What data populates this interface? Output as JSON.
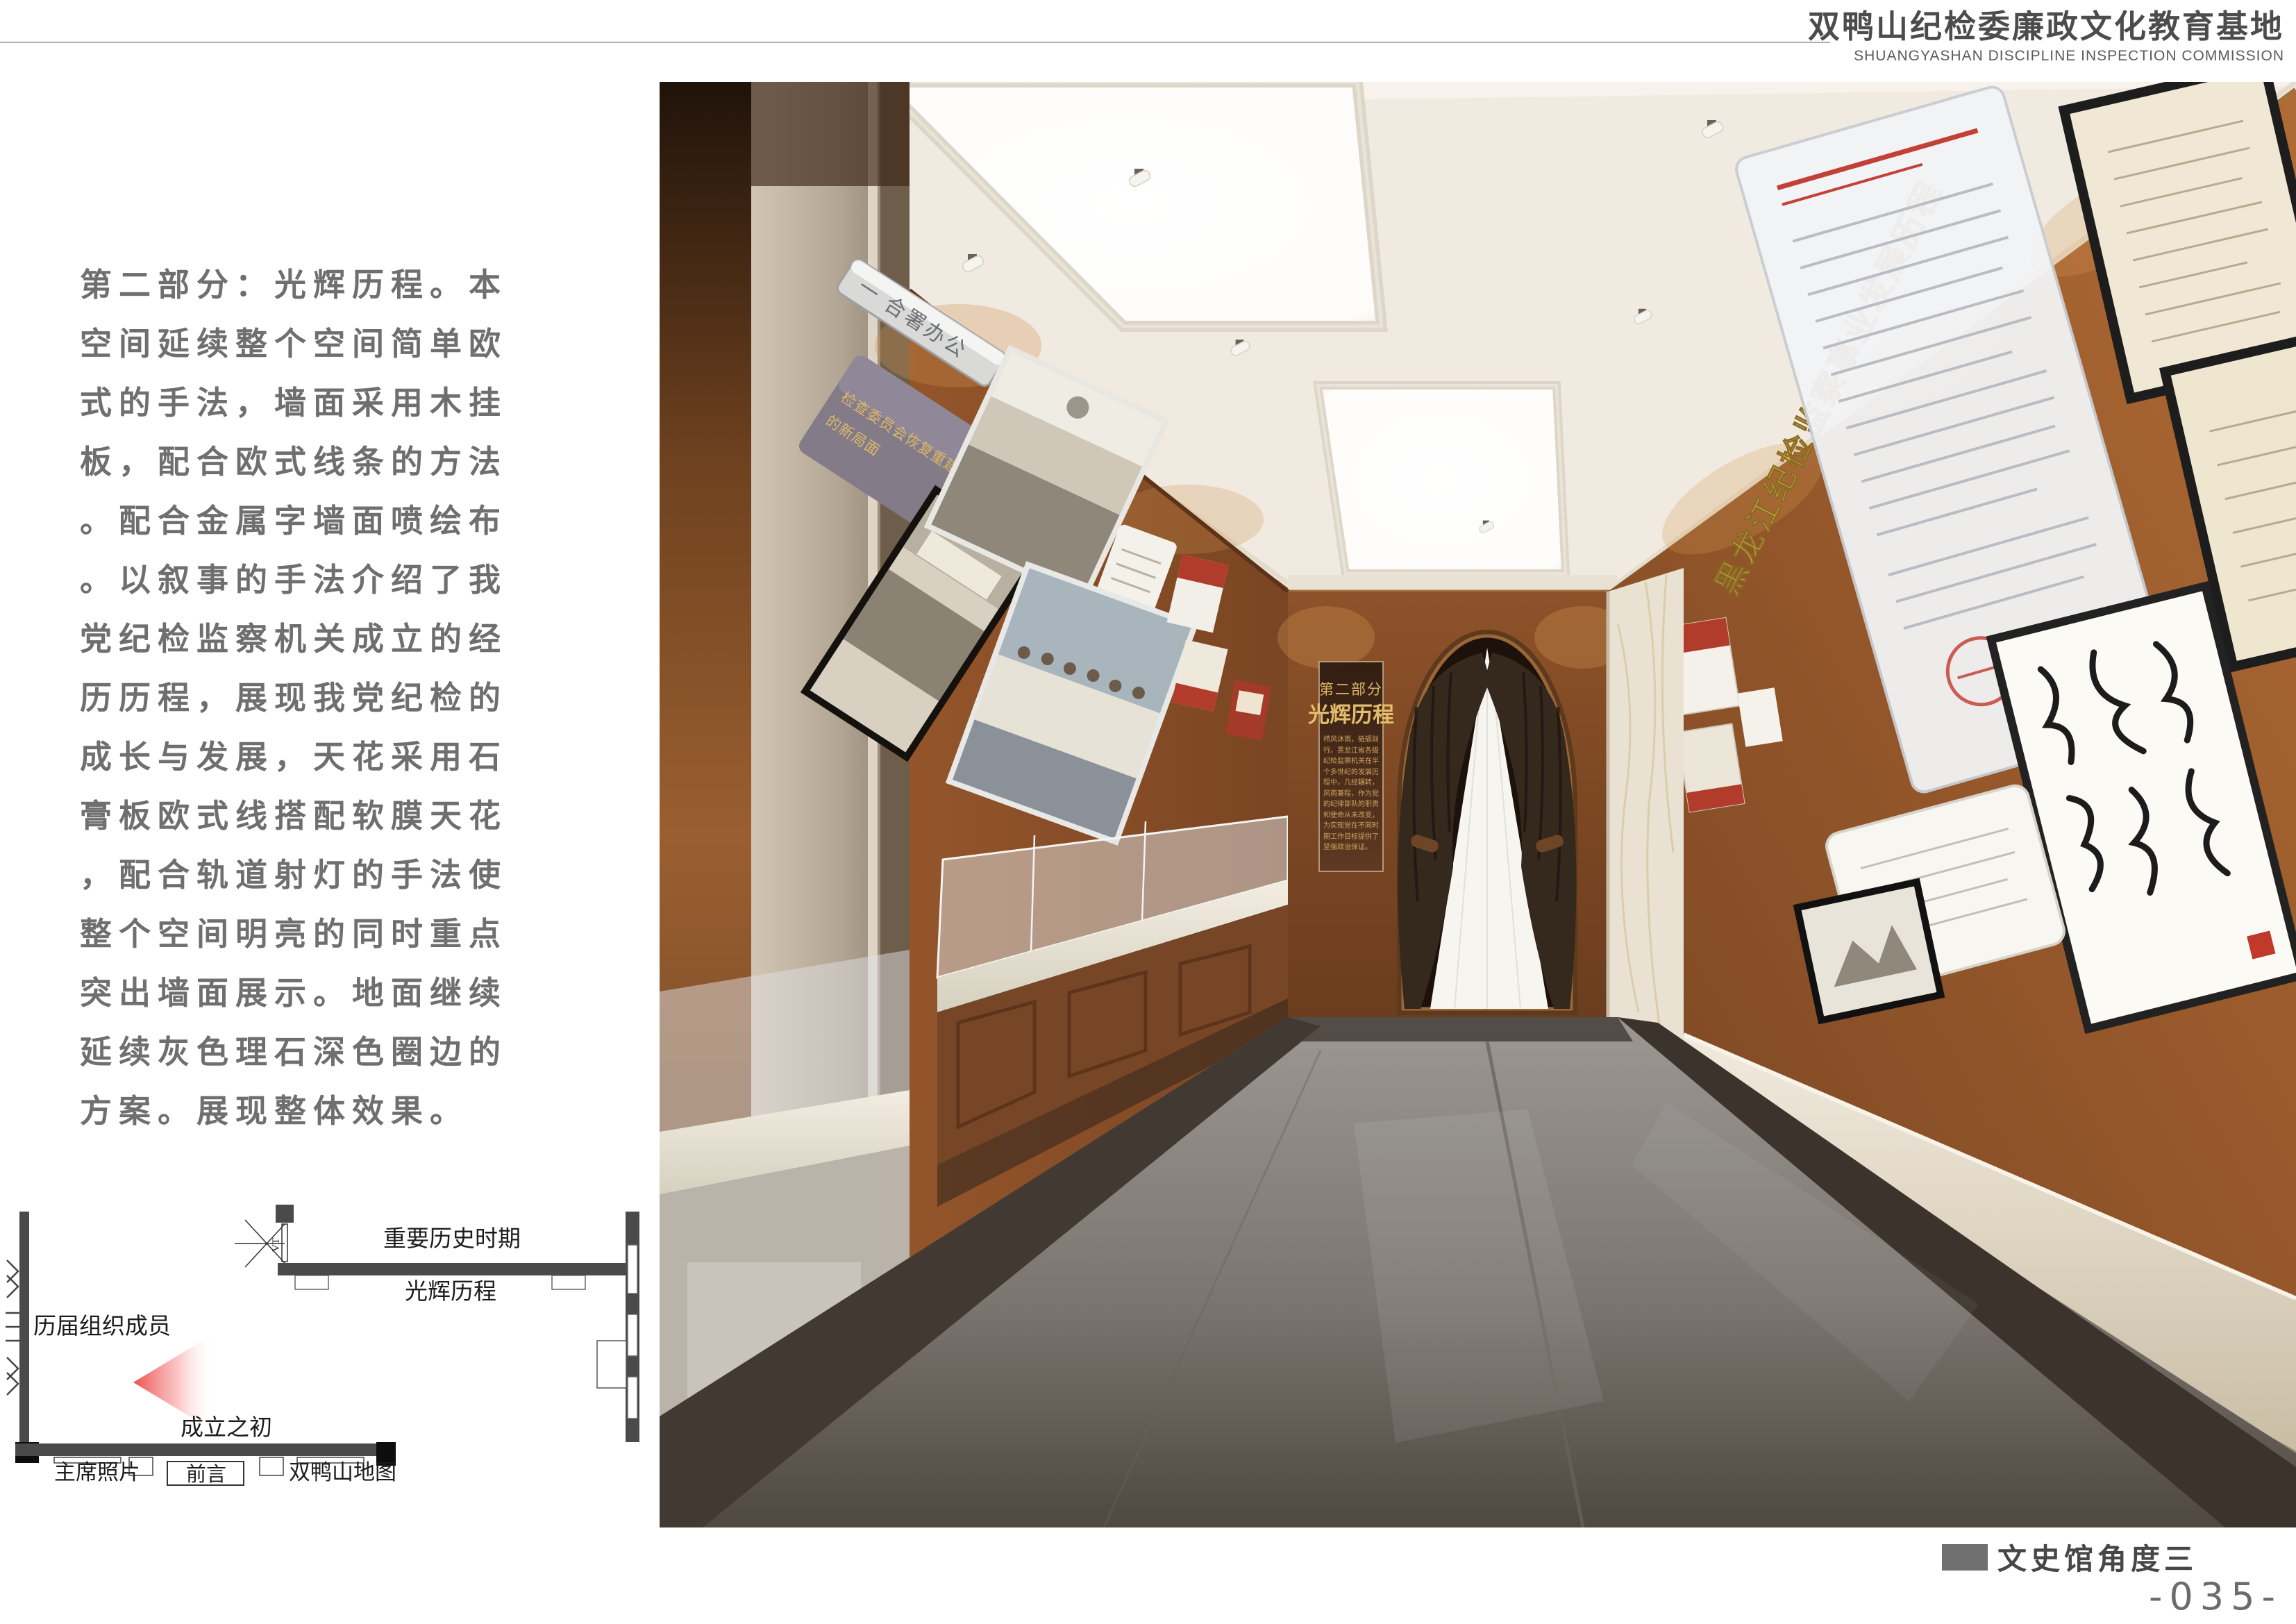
{
  "header": {
    "title": "双鸭山纪检委廉政文化教育基地",
    "subtitle": "SHUANGYASHAN DISCIPLINE INSPECTION COMMISSION"
  },
  "description": {
    "lines": [
      "第二部分：光辉历程。本",
      "空间延续整个空间简单欧",
      "式的手法，墙面采用木挂",
      "板，配合欧式线条的方法",
      "。配合金属字墙面喷绘布",
      "。以叙事的手法介绍了我",
      "党纪检监察机关成立的经",
      "历历程，展现我党纪检的",
      "成长与发展，天花采用石",
      "膏板欧式线搭配软膜天花",
      "，配合轨道射灯的手法使",
      "整个空间明亮的同时重点",
      "突出墙面展示。地面继续",
      "延续灰色理石深色圈边的",
      "方案。展现整体效果。"
    ]
  },
  "floor_plan": {
    "labels": {
      "important_period": "重要历史时期",
      "glorious_course": "光辉历程",
      "members": "历届组织成员",
      "founding": "成立之初",
      "chairman_photos": "主席照片",
      "preface": "前言",
      "map": "双鸭山地图",
      "door_mark": "VT"
    }
  },
  "render": {
    "gold_wall_title": "黑龙江纪检监察事业发展历程",
    "plaque": "一 合署办公",
    "panel_line1": "检查委员会恢复重建，开创了",
    "panel_line2": "的新局面",
    "banner": {
      "part": "第二部分",
      "title": "光辉历程",
      "body": "栉风沐雨，砥砺前行。黑龙江省各级纪检监察机关在半个多世纪的发展历程中，几经辗转，风雨兼程，作为党的纪律部队的职责和使命从未改变，为实现党在不同时期工作目标提供了坚强政治保证。"
    }
  },
  "footer": {
    "caption": "文史馆角度三",
    "page_number": "-035-"
  },
  "colors": {
    "wood": "#8a5129",
    "gold": "#d4a94f",
    "floor_gray": "#807b75",
    "plan_wall": "#4a4a4a",
    "cone_red": "#ee4343",
    "legend_gray": "#6f6f6f",
    "text_gray": "#6f6f6f"
  }
}
